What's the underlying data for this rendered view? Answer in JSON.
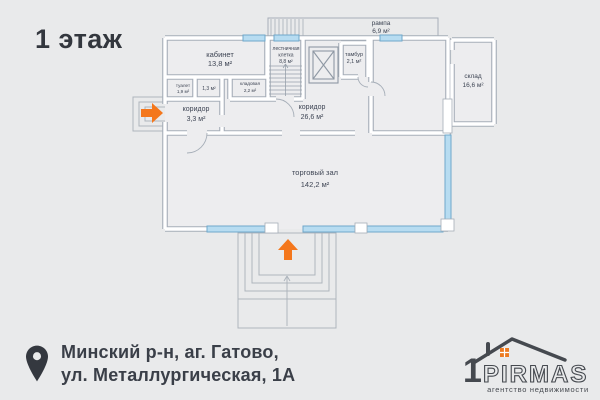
{
  "title": "1 этаж",
  "plan": {
    "rooms": {
      "office": {
        "name": "кабинет",
        "area": "13,8 м²"
      },
      "stairwell": {
        "name_line1": "лестничная",
        "name_line2": "клетка",
        "area": "8,8 м²"
      },
      "ramp": {
        "name": "рампа",
        "area": "6,9 м²"
      },
      "vestibule": {
        "name": "тамбур",
        "area": "2,1 м²"
      },
      "warehouse": {
        "name": "склад",
        "area": "16,6 м²"
      },
      "corridor_main": {
        "name": "коридор",
        "area": "26,6 м²"
      },
      "corridor_small": {
        "name": "коридор",
        "area": "3,3 м²"
      },
      "toilet": {
        "name": "туалет",
        "area": "1,9 м²"
      },
      "utility": {
        "area": "1,3 м²"
      },
      "storage": {
        "name": "кладовая",
        "area": "2,2 м²"
      },
      "sales_hall": {
        "name": "торговый зал",
        "area": "142,2 м²"
      }
    }
  },
  "address": {
    "line1": "Минский р-н, аг. Гатово,",
    "line2": "ул. Металлургическая, 1А"
  },
  "logo": {
    "digit": "1",
    "brand": "PIRMAS",
    "tagline": "агентство недвижимости"
  },
  "colors": {
    "background": "#e9eaeb",
    "wall_gray": "#a6aeb8",
    "room_fill": "#ededef",
    "window_blue": "#b7dcf1",
    "window_blue_border": "#6fa8cb",
    "accent_orange": "#f4771c",
    "text_dark": "#3e4554",
    "logo_dark": "#45494f"
  }
}
